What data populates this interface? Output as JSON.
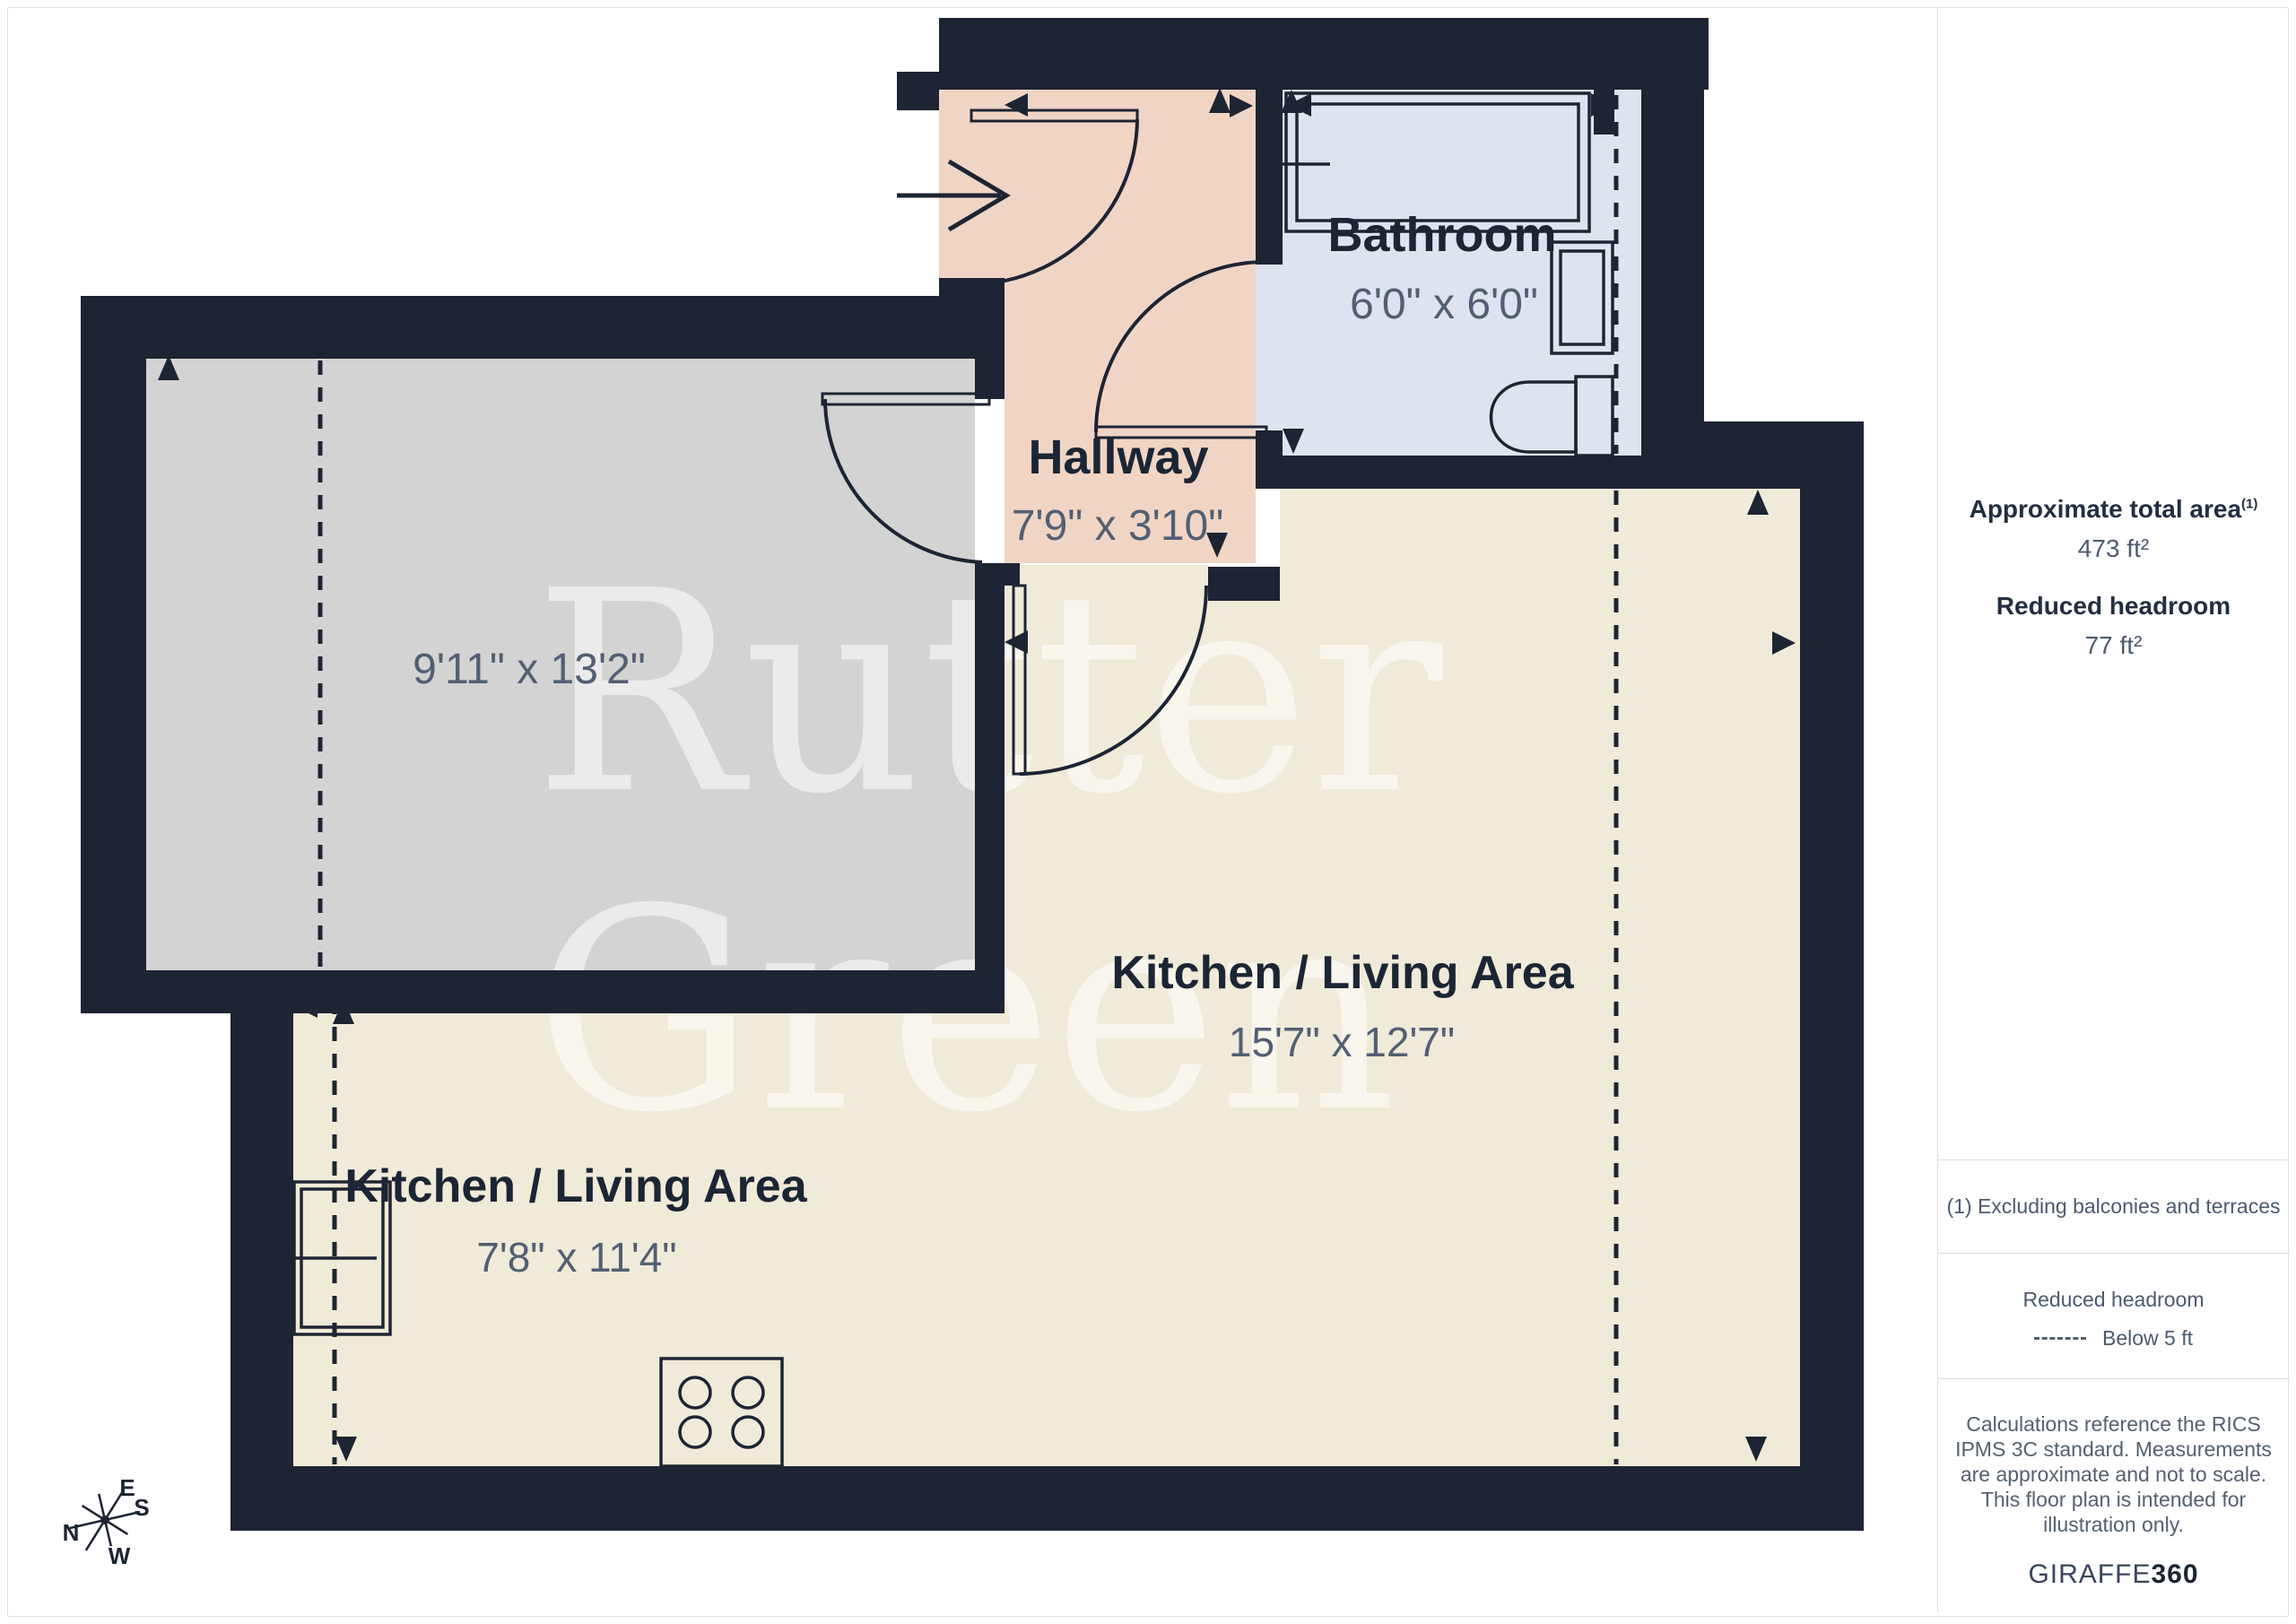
{
  "colors": {
    "wall": "#1d2433",
    "gray": "#d3d3d3",
    "pink": "#f0d5c5",
    "blue": "#dee3f0",
    "cream": "#f0ead8",
    "dim": "#525f73",
    "name": "#1c2534"
  },
  "watermark": {
    "line1": "Rutter",
    "line2": "Green"
  },
  "floorplan": {
    "rooms": {
      "bathroom": {
        "name": "Bathroom",
        "dims": "6'0\" x 6'0\""
      },
      "hallway": {
        "name": "Hallway",
        "dims": "7'9\" x 3'10\""
      },
      "unnamed_room": {
        "dims": "9'11\" x 13'2\""
      },
      "kitchen_living_right": {
        "name": "Kitchen / Living Area",
        "dims": "15'7\" x 12'7\""
      },
      "kitchen_living_left": {
        "name": "Kitchen / Living Area",
        "dims": "7'8\" x 11'4\""
      }
    },
    "compass": {
      "n": "N",
      "e": "E",
      "s": "S",
      "w": "W"
    }
  },
  "sidebar": {
    "total_area_label": "Approximate total area",
    "total_area_marker": "(1)",
    "total_area_value": "473 ft²",
    "reduced_headroom_label": "Reduced headroom",
    "reduced_headroom_value": "77 ft²",
    "footnote": "(1) Excluding balconies and terraces",
    "legend_title": "Reduced headroom",
    "legend_item": "Below 5 ft",
    "disclaimer": "Calculations reference the RICS IPMS 3C standard. Measurements are approximate and not to scale. This floor plan is intended for illustration only.",
    "brand_name": "GIRAFFE",
    "brand_number": "360"
  }
}
